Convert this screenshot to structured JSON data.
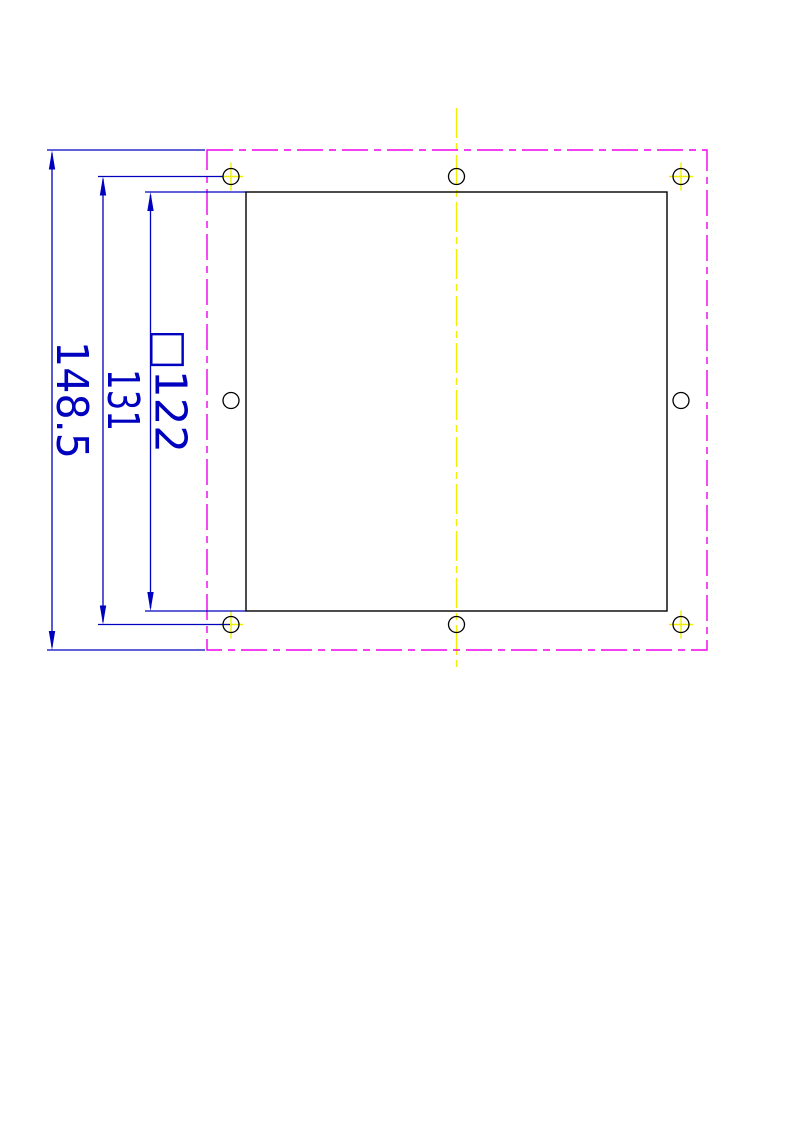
{
  "colors": {
    "dimension_blue": "#0000bf",
    "outline_black": "#000000",
    "phantom_magenta": "#ee00ee",
    "centerline_yellow": "#f0f000",
    "background": "#ffffff"
  },
  "dimensions": {
    "overall_height": {
      "label": "148.5"
    },
    "hole_spacing": {
      "label": "131"
    },
    "cutout": {
      "label": "□122"
    }
  }
}
